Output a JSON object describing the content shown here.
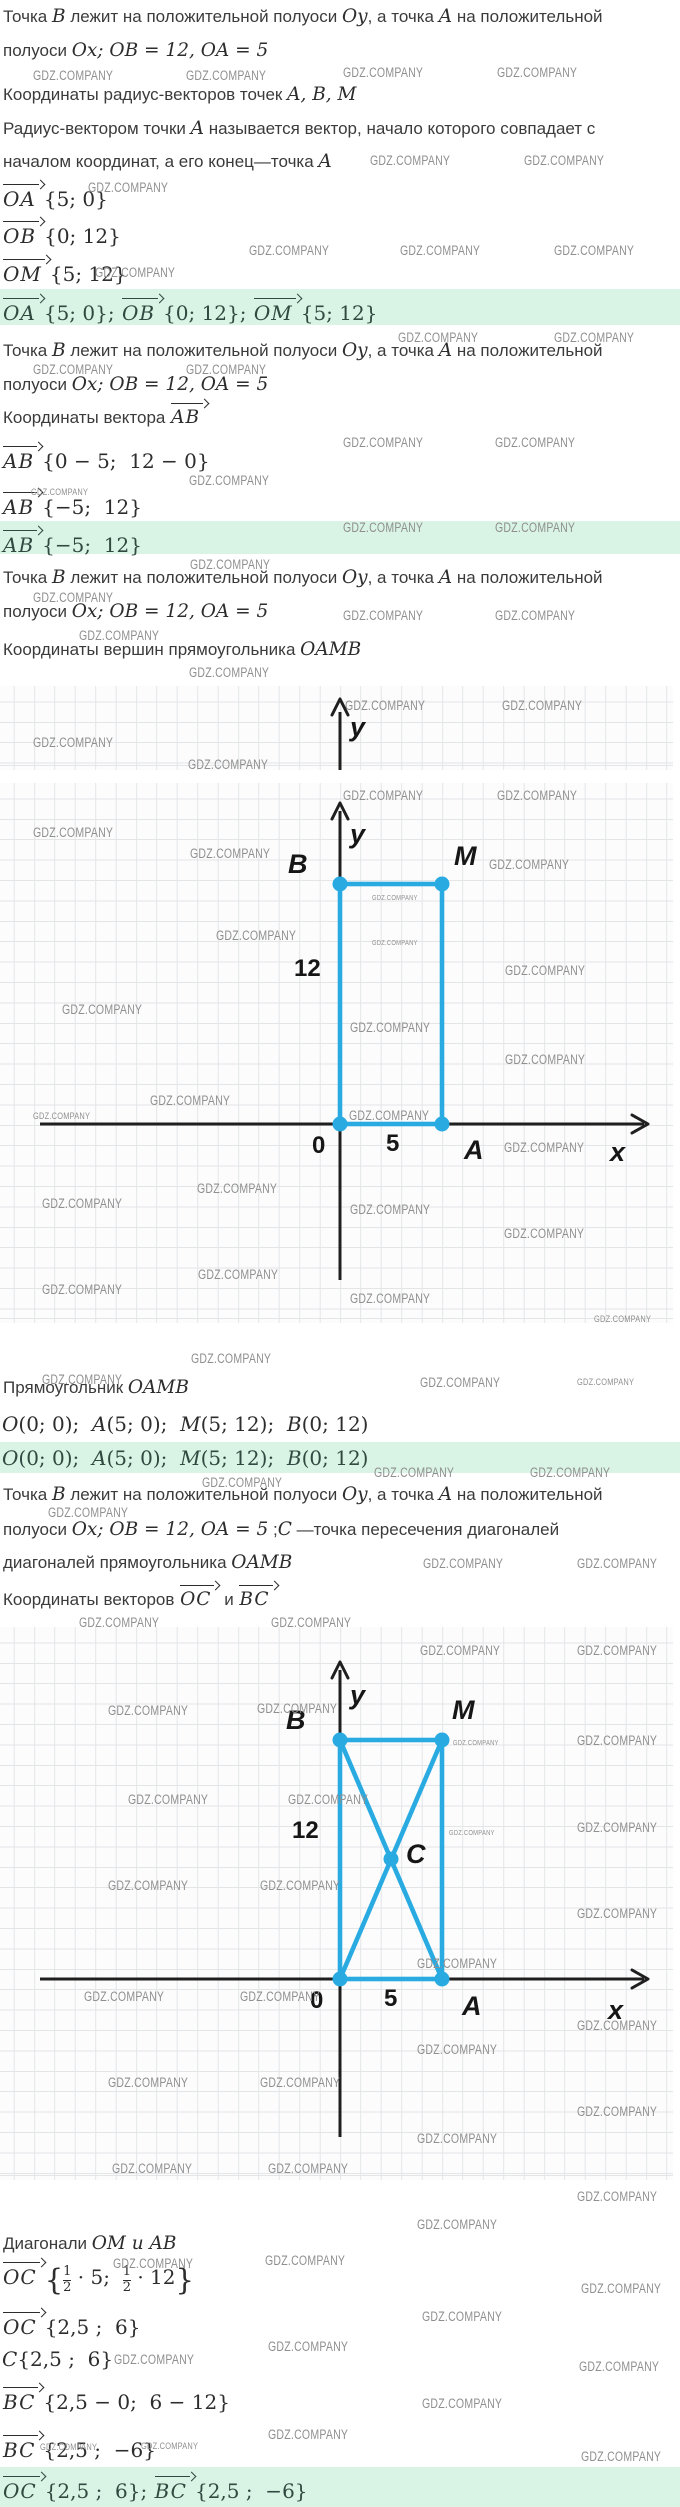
{
  "colors": {
    "accent_blue": "#29abe2",
    "answer_bg": "#d9f3e4",
    "answer_text": "#2f4a40",
    "text": "#3b3b3b",
    "math": "#2d2d2d",
    "watermark": "#8f8f8f",
    "grid": "#e3e5e7",
    "grid_bg": "#fcfcfc",
    "axis": "#1f1f1f"
  },
  "t": {
    "intro1a": [
      "Точка ",
      "B",
      " лежит на положительной полуоси ",
      "Oy",
      ", а точка ",
      "A",
      " на положительной"
    ],
    "intro1b": [
      "полуоси ",
      "Ox; OB = 12, OA = 5"
    ],
    "h1": [
      "Координаты радиус-векторов точек ",
      "A, B, M"
    ],
    "def1": [
      "Радиус-вектором точки ",
      "A",
      " называется вектор, начало которого совпадает с"
    ],
    "def2": [
      "началом координат, а его конец—точка ",
      "A"
    ],
    "h2pre": "Координаты вектора ",
    "h2v": "AB",
    "h3": [
      "Координаты вершин прямоугольника ",
      "OAMB"
    ],
    "rect": [
      "Прямоугольник ",
      "OAMB"
    ],
    "coords": [
      "O",
      "(0; 0);  ",
      "A",
      "(5; 0);  ",
      "M",
      "(5; 12);  ",
      "B",
      "(0; 12)"
    ],
    "intro4b": [
      "полуоси ",
      "Ox; OB = 12, OA = 5",
      " ;",
      "C",
      " —точка пересечения диагоналей"
    ],
    "intro4c": [
      "диагоналей прямоугольника ",
      "OAMB"
    ],
    "h4pre": "Координаты векторов ",
    "h4v1": "OC",
    "h4mid": " и ",
    "h4v2": "BC",
    "diag": [
      "Диагонали ",
      "OM и AB"
    ]
  },
  "f": {
    "oa": {
      "v": "OA",
      "r": "{5; 0}"
    },
    "ob": {
      "v": "OB",
      "r": "{0; 12}"
    },
    "om": {
      "v": "OM",
      "r": "{5; 12}"
    },
    "ans1": {
      "v1": "OA",
      "r1": "{5; 0}; ",
      "v2": "OB",
      "r2": "{0; 12}; ",
      "v3": "OM",
      "r3": "{5; 12}"
    },
    "ab1": {
      "v": "AB",
      "r": "{0 − 5;  12 − 0}"
    },
    "ab2": {
      "v": "AB",
      "r": "{−5;  12}"
    },
    "ans2": {
      "v": "AB",
      "r": "{−5;  12}"
    },
    "oc1": {
      "v": "OC",
      "o": "{",
      "n1": "1",
      "d1": "2",
      "m1": " · 5;  ",
      "n2": "1",
      "d2": "2",
      "m2": " · 12",
      "c": "}"
    },
    "oc2": {
      "v": "OC",
      "r": "{2,5 ;  6}"
    },
    "c": {
      "v": "C",
      "r": "{2,5 ;  6}"
    },
    "bc1": {
      "v": "BC",
      "r": "{2,5 − 0;  6 − 12}"
    },
    "bc2": {
      "v": "BC",
      "r": "{2,5 ;  −6}"
    },
    "ans4": {
      "v1": "OC",
      "r1": "{2,5 ;  6}; ",
      "v2": "BC",
      "r2": "{2,5 ;  −6}"
    }
  },
  "fig_band": {
    "y": "y"
  },
  "fig1": {
    "y": "y",
    "B": "B",
    "M": "M",
    "d12": "12",
    "d0": "0",
    "d5": "5",
    "A": "A",
    "x": "x",
    "points": {
      "O": [
        0,
        0
      ],
      "A": [
        5,
        0
      ],
      "M": [
        5,
        12
      ],
      "B": [
        0,
        12
      ]
    }
  },
  "fig2": {
    "y": "y",
    "B": "B",
    "M": "M",
    "d12": "12",
    "C": "C",
    "d0": "0",
    "d5": "5",
    "A": "A",
    "x": "x",
    "points": {
      "O": [
        0,
        0
      ],
      "A": [
        5,
        0
      ],
      "M": [
        5,
        12
      ],
      "B": [
        0,
        12
      ],
      "C": [
        2.5,
        6
      ]
    }
  },
  "watermark": {
    "text": "GDZ.COMPANY",
    "positions": [
      [
        33,
        68
      ],
      [
        186,
        68
      ],
      [
        343,
        65
      ],
      [
        497,
        65
      ],
      [
        370,
        153
      ],
      [
        524,
        153
      ],
      [
        88,
        180
      ],
      [
        249,
        243
      ],
      [
        400,
        243
      ],
      [
        554,
        243
      ],
      [
        95,
        265
      ],
      [
        398,
        330
      ],
      [
        554,
        330
      ],
      [
        33,
        362
      ],
      [
        186,
        362
      ],
      [
        343,
        435
      ],
      [
        495,
        435
      ],
      [
        189,
        473
      ],
      [
        31,
        487,
        "s"
      ],
      [
        343,
        520
      ],
      [
        495,
        520
      ],
      [
        190,
        557
      ],
      [
        33,
        590
      ],
      [
        343,
        608
      ],
      [
        495,
        608
      ],
      [
        79,
        628
      ],
      [
        189,
        665
      ],
      [
        345,
        698
      ],
      [
        502,
        698
      ],
      [
        33,
        735
      ],
      [
        188,
        757
      ],
      [
        343,
        788
      ],
      [
        497,
        788
      ],
      [
        33,
        825
      ],
      [
        190,
        846
      ],
      [
        489,
        857
      ],
      [
        372,
        893,
        "t"
      ],
      [
        372,
        938,
        "t"
      ],
      [
        216,
        928
      ],
      [
        505,
        963
      ],
      [
        62,
        1002
      ],
      [
        350,
        1020
      ],
      [
        505,
        1052
      ],
      [
        150,
        1093
      ],
      [
        33,
        1111,
        "s"
      ],
      [
        349,
        1108
      ],
      [
        504,
        1140
      ],
      [
        197,
        1181
      ],
      [
        42,
        1196
      ],
      [
        350,
        1202
      ],
      [
        504,
        1226
      ],
      [
        198,
        1267
      ],
      [
        42,
        1282
      ],
      [
        350,
        1291
      ],
      [
        594,
        1314,
        "s"
      ],
      [
        191,
        1351
      ],
      [
        42,
        1372
      ],
      [
        420,
        1375
      ],
      [
        577,
        1377,
        "s"
      ],
      [
        202,
        1475
      ],
      [
        374,
        1465
      ],
      [
        530,
        1465
      ],
      [
        48,
        1505
      ],
      [
        423,
        1556
      ],
      [
        577,
        1556
      ],
      [
        79,
        1615
      ],
      [
        271,
        1615
      ],
      [
        420,
        1643
      ],
      [
        577,
        1643
      ],
      [
        108,
        1703
      ],
      [
        257,
        1701
      ],
      [
        577,
        1733
      ],
      [
        453,
        1738,
        "t"
      ],
      [
        128,
        1792
      ],
      [
        288,
        1792
      ],
      [
        577,
        1820
      ],
      [
        449,
        1828,
        "t"
      ],
      [
        108,
        1878
      ],
      [
        260,
        1878
      ],
      [
        577,
        1906
      ],
      [
        417,
        1956
      ],
      [
        84,
        1989
      ],
      [
        240,
        1989
      ],
      [
        577,
        2018
      ],
      [
        417,
        2042
      ],
      [
        108,
        2075
      ],
      [
        260,
        2075
      ],
      [
        577,
        2104
      ],
      [
        417,
        2131
      ],
      [
        112,
        2161
      ],
      [
        268,
        2161
      ],
      [
        577,
        2189
      ],
      [
        417,
        2217
      ],
      [
        113,
        2256
      ],
      [
        265,
        2253
      ],
      [
        581,
        2281
      ],
      [
        422,
        2309
      ],
      [
        268,
        2339
      ],
      [
        114,
        2352
      ],
      [
        579,
        2359
      ],
      [
        422,
        2396
      ],
      [
        268,
        2427
      ],
      [
        40,
        2442,
        "s"
      ],
      [
        141,
        2441,
        "s"
      ],
      [
        581,
        2449
      ]
    ]
  }
}
